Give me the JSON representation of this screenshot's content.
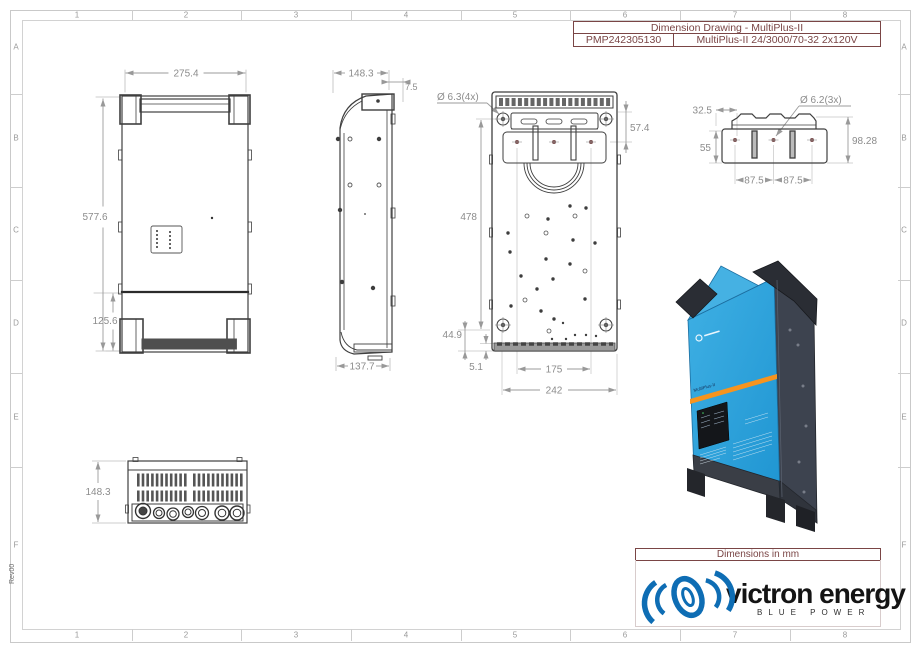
{
  "frame": {
    "columns": [
      "1",
      "2",
      "3",
      "4",
      "5",
      "6",
      "7",
      "8"
    ],
    "rows": [
      "A",
      "B",
      "C",
      "D",
      "E",
      "F"
    ],
    "revision": "Rev00"
  },
  "title_block": {
    "title": "Dimension Drawing - MultiPlus-II",
    "part_number": "PMP242305130",
    "model": "MultiPlus-II 24/3000/70-32 2x120V"
  },
  "views": {
    "front": {
      "width": "275.4",
      "height": "577.6",
      "bottom_section_height": "125.6"
    },
    "side": {
      "depth": "148.3",
      "top_offset": "7.5",
      "bottom_depth": "137.7"
    },
    "back": {
      "hole_note": "Ø 6.3(4x)",
      "bracket_offset": "57.4",
      "hole_height": "478",
      "bottom_offset": "44.9",
      "base_offset": "5.1",
      "hole_width": "175",
      "overall_width": "242"
    },
    "top": {
      "side_offset": "32.5",
      "plate_depth": "55",
      "hole_note": "Ø 6.2(3x)",
      "overall_depth": "98.28",
      "hole_pitch_a": "87.5",
      "hole_pitch_b": "87.5"
    },
    "bottom": {
      "depth": "148.3"
    }
  },
  "product": {
    "label": "MultiPlus-II"
  },
  "footer": {
    "units_note": "Dimensions in mm",
    "brand": "victron energy",
    "tagline": "BLUE POWER"
  },
  "colors": {
    "maroon": "#7a4545",
    "victron_blue": "#0e6db4",
    "product_blue": "#2ba3dc",
    "product_dark": "#3d434f",
    "orange_stripe": "#f7941e",
    "dim_gray": "#8c8c8c"
  }
}
